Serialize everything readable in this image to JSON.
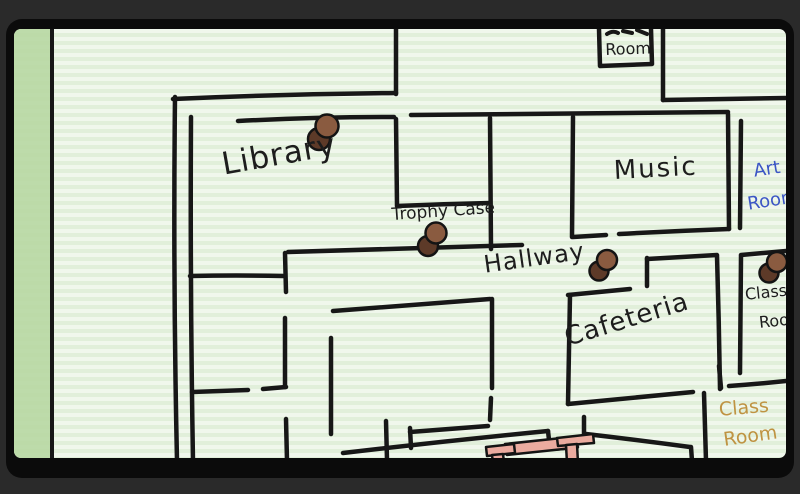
{
  "screen": {
    "description": "Hand-drawn school floor-plan map on green lined notebook paper inside a dark rounded frame"
  },
  "labels": {
    "library": "Library",
    "trophy_case": "Trophy Case",
    "music": "Music",
    "hallway": "Hallway",
    "cafeteria": "Cafeteria",
    "top_room": "Room",
    "art_room_line1": "Art",
    "art_room_line2": "Room",
    "class_room_right_line1": "Class",
    "class_room_right_line2": "Room",
    "class_room_bottom_line1": "Class",
    "class_room_bottom_line2": "Room"
  },
  "pins": [
    {
      "name": "library-pin",
      "location": "library"
    },
    {
      "name": "trophy-case-pin",
      "location": "trophy-case"
    },
    {
      "name": "hallway-pin",
      "location": "hallway"
    },
    {
      "name": "class-room-pin",
      "location": "class-room-right"
    }
  ],
  "colors": {
    "paper": "#f0f7ec",
    "paper_rule": "#e1efda",
    "margin_strip": "#b9d8a4",
    "wall": "#171717",
    "ink": "#1d1d1d",
    "pin_light": "#8a5b40",
    "pin_dark": "#5d3a28",
    "art_room_text": "#3b55c5",
    "class_room_bottom_text": "#bf9342",
    "bench": "#ebab9f",
    "frame": "#0b0b0b",
    "surround": "#2a2a2a"
  }
}
